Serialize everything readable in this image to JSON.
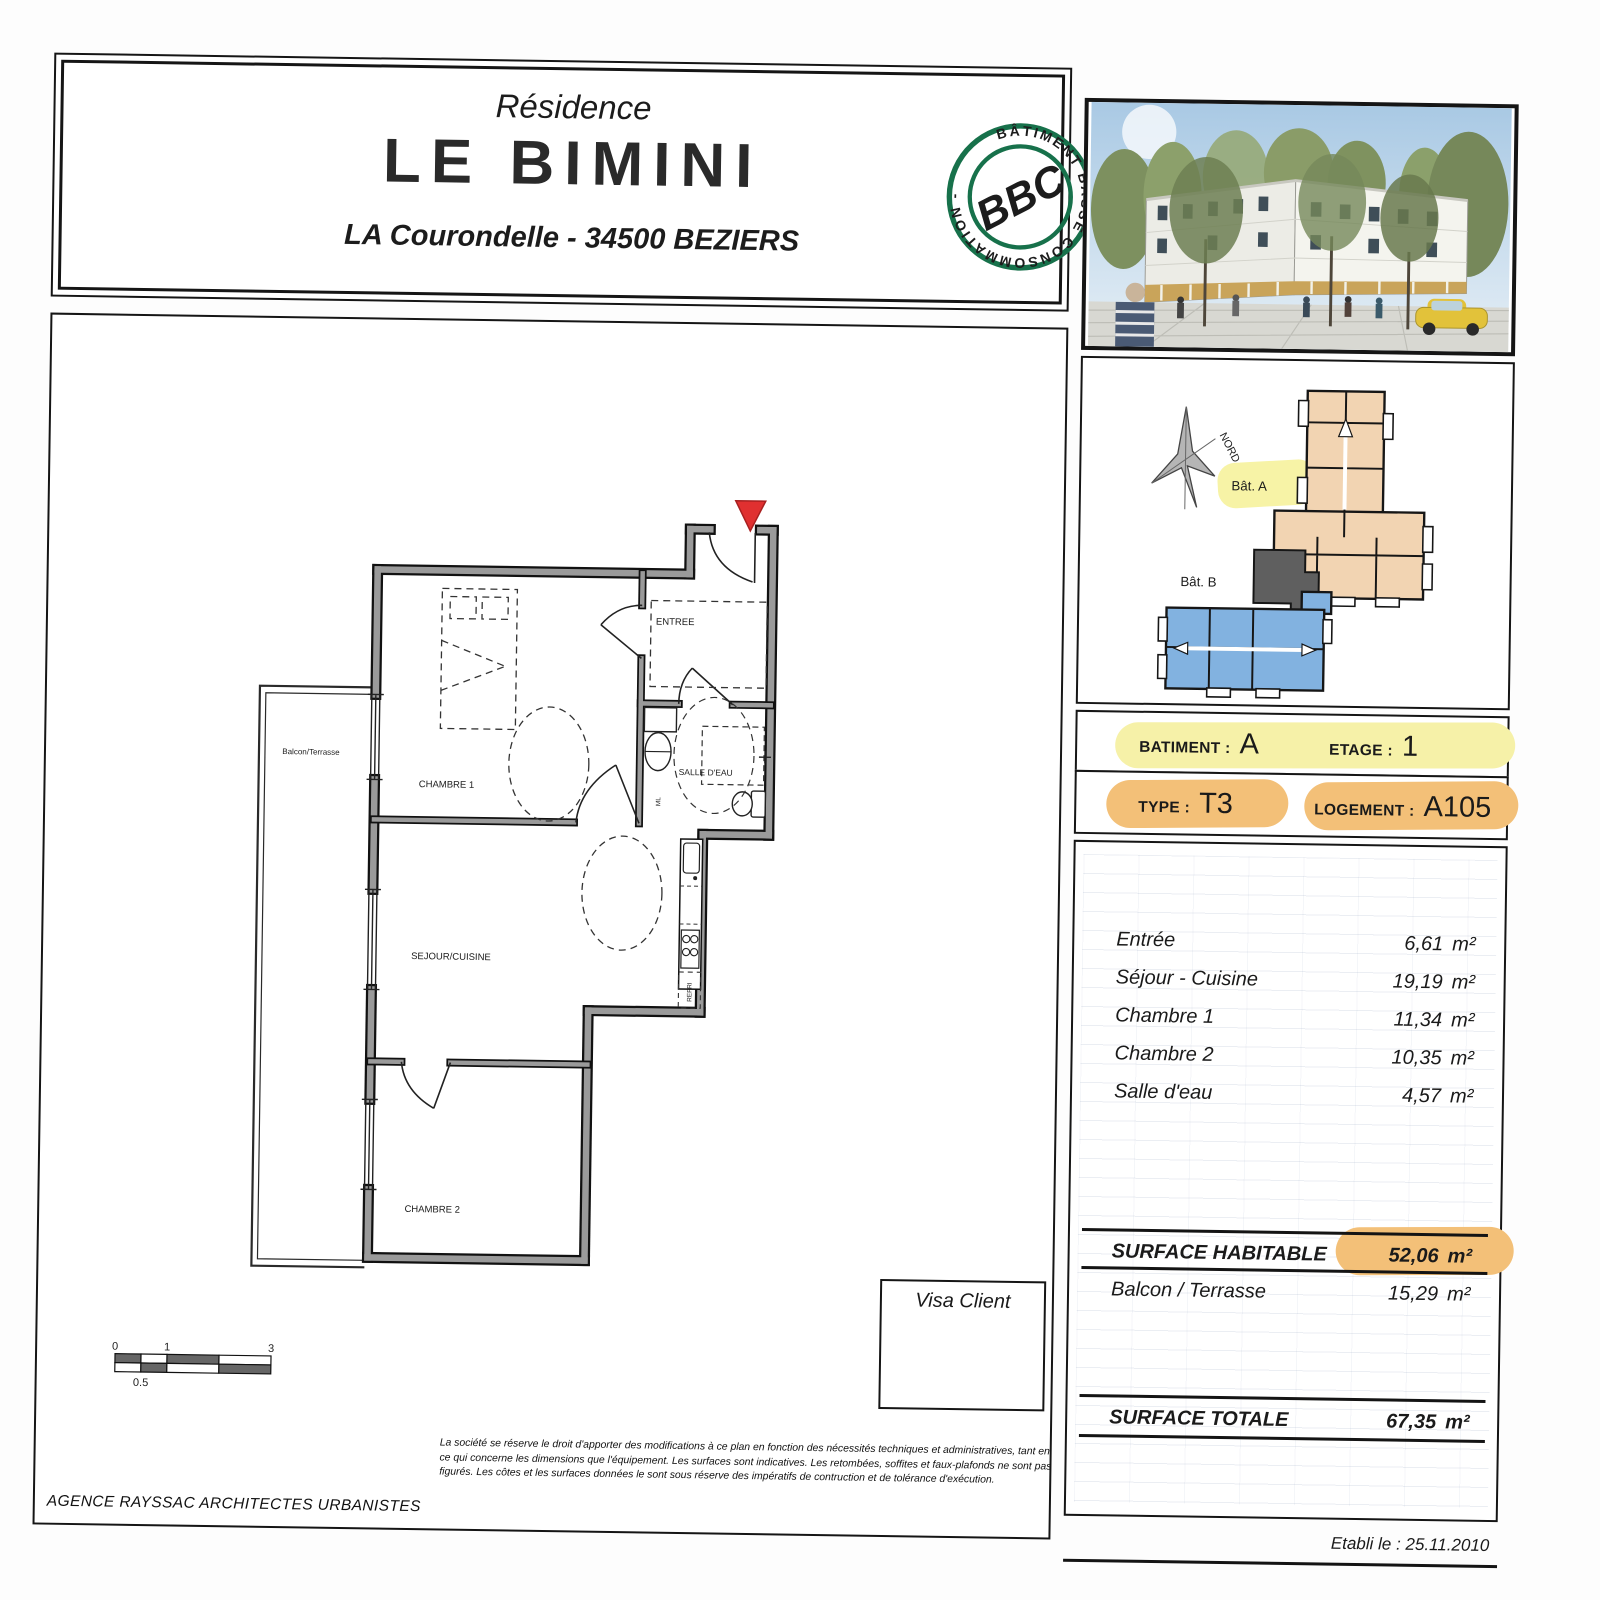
{
  "title": {
    "residence": "Résidence",
    "name": "LE BIMINI",
    "address": "LA Courondelle - 34500 BEZIERS"
  },
  "stamp": {
    "ring": "BÂTIMENT BASSE CONSOMMATION - ",
    "center": "BBC",
    "color": "#17714b"
  },
  "siteplan": {
    "north": "NORD",
    "bat_a": "Bât. A",
    "bat_b": "Bât. B"
  },
  "info": {
    "batiment_label": "BATIMENT :",
    "batiment_value": "A",
    "etage_label": "ETAGE :",
    "etage_value": "1",
    "type_label": "TYPE :",
    "type_value": "T3",
    "logement_label": "LOGEMENT :",
    "logement_value": "A105"
  },
  "areas": {
    "rooms": [
      {
        "label": "Entrée",
        "value": "6,61",
        "unit": "m²"
      },
      {
        "label": "Séjour - Cuisine",
        "value": "19,19",
        "unit": "m²"
      },
      {
        "label": "Chambre 1",
        "value": "11,34",
        "unit": "m²"
      },
      {
        "label": "Chambre 2",
        "value": "10,35",
        "unit": "m²"
      },
      {
        "label": "Salle d'eau",
        "value": "4,57",
        "unit": "m²"
      }
    ],
    "surface_habitable": {
      "label": "SURFACE HABITABLE",
      "value": "52,06",
      "unit": "m²"
    },
    "balcon": {
      "label": "Balcon / Terrasse",
      "value": "15,29",
      "unit": "m²"
    },
    "surface_totale": {
      "label": "SURFACE TOTALE",
      "value": "67,35",
      "unit": "m²"
    }
  },
  "plan": {
    "balcony": "Balcon/Terrasse",
    "chambre1": "CHAMBRE 1",
    "entree": "ENTREE",
    "salle_deau": "SALLE D'EAU",
    "sejour": "SEJOUR/CUISINE",
    "chambre2": "CHAMBRE 2",
    "refri": "REFRI",
    "ml": "ML"
  },
  "scalebar": {
    "t0": "0",
    "t1": "1",
    "t3": "3",
    "thalf": "0.5"
  },
  "visa": {
    "label": "Visa Client"
  },
  "footer": {
    "agency": "AGENCE RAYSSAC ARCHITECTES URBANISTES",
    "disclaimer": "La société se réserve le droit d'apporter des modifications à ce plan en fonction des nécessités techniques et administratives, tant en ce qui concerne les dimensions que l'équipement. Les surfaces sont indicatives. Les retombées, soffites et faux-plafonds ne sont pas figurés. Les côtes et les surfaces données le sont sous réserve des impératifs de contruction et de tolérance d'exécution.",
    "date": "Etabli le : 25.11.2010"
  },
  "colors": {
    "bat_a": "#f2d4b2",
    "bat_b": "#82b2e0",
    "unit_marker": "#5f5f5f",
    "highlight_yellow": "#f6f1a8",
    "highlight_orange": "#f3c078",
    "stamp_green": "#17714b",
    "entry_marker_red": "#e03030"
  }
}
